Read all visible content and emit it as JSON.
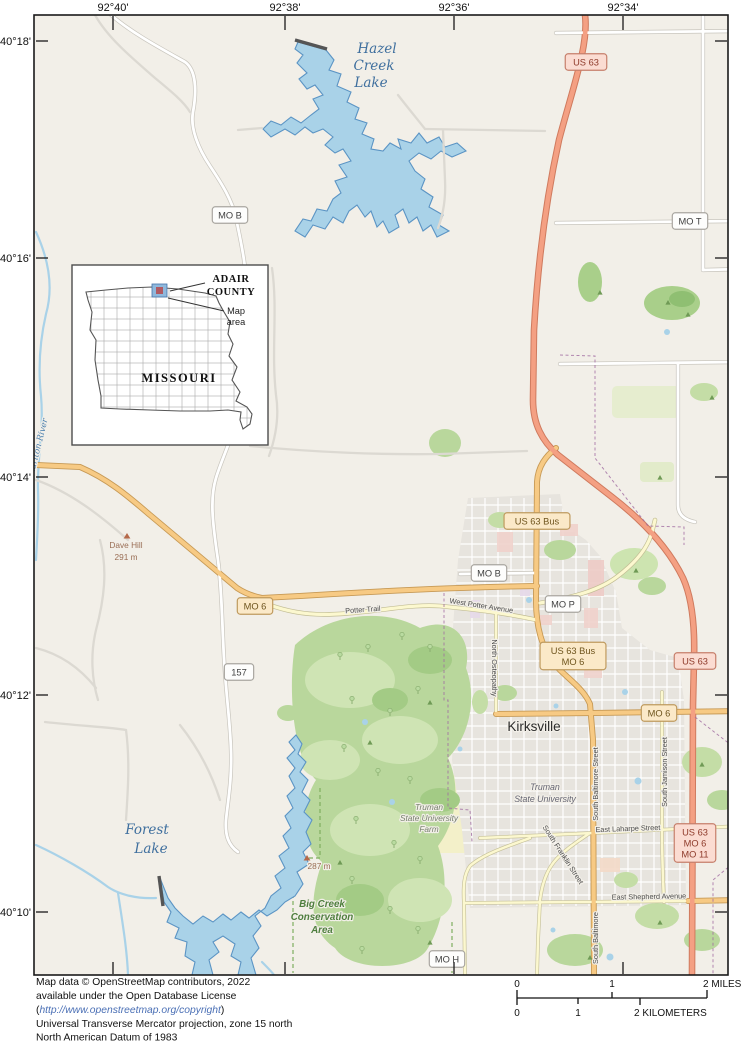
{
  "map": {
    "coordinates": {
      "top": [
        "92°40'",
        "92°38'",
        "92°36'",
        "92°34'"
      ],
      "left": [
        "40°18'",
        "40°16'",
        "40°14'",
        "40°12'",
        "40°10'"
      ]
    },
    "inset": {
      "county_line1": "ADAIR",
      "county_line2": "COUNTY",
      "map_area_line1": "Map",
      "map_area_line2": "area",
      "state": "MISSOURI"
    },
    "shields": [
      {
        "name": "shield-us63-north",
        "type": "us",
        "lines": [
          "US 63"
        ],
        "x": 586,
        "y": 62
      },
      {
        "name": "shield-us63-east",
        "type": "us",
        "lines": [
          "US 63"
        ],
        "x": 695,
        "y": 661
      },
      {
        "name": "shield-us63-mo6-mo11",
        "type": "us",
        "lines": [
          "US 63",
          "MO 6",
          "MO 11"
        ],
        "x": 695,
        "y": 843
      },
      {
        "name": "shield-us63-bus",
        "type": "tan",
        "lines": [
          "US 63 Bus"
        ],
        "x": 537,
        "y": 521
      },
      {
        "name": "shield-us63-bus-mo6",
        "type": "tan",
        "lines": [
          "US 63 Bus",
          "MO 6"
        ],
        "x": 573,
        "y": 656
      },
      {
        "name": "shield-mo6-west",
        "type": "tan",
        "lines": [
          "MO 6"
        ],
        "x": 255,
        "y": 606
      },
      {
        "name": "shield-mo6-east",
        "type": "tan",
        "lines": [
          "MO 6"
        ],
        "x": 659,
        "y": 713
      },
      {
        "name": "shield-mo-b-north",
        "type": "white",
        "lines": [
          "MO B"
        ],
        "x": 230,
        "y": 215
      },
      {
        "name": "shield-mo-b-city",
        "type": "white",
        "lines": [
          "MO B"
        ],
        "x": 489,
        "y": 573
      },
      {
        "name": "shield-mo-p",
        "type": "white",
        "lines": [
          "MO P"
        ],
        "x": 563,
        "y": 604
      },
      {
        "name": "shield-mo-t",
        "type": "white",
        "lines": [
          "MO T"
        ],
        "x": 690,
        "y": 221
      },
      {
        "name": "shield-157",
        "type": "white",
        "lines": [
          "157"
        ],
        "x": 239,
        "y": 672
      },
      {
        "name": "shield-mo-h",
        "type": "white",
        "lines": [
          "MO H"
        ],
        "x": 447,
        "y": 959
      }
    ],
    "labels": [
      {
        "name": "hazel-creek-lake-label-1",
        "text": "Hazel",
        "x": 377,
        "y": 53,
        "cls": "lake"
      },
      {
        "name": "hazel-creek-lake-label-2",
        "text": "Creek",
        "x": 374,
        "y": 70,
        "cls": "lake"
      },
      {
        "name": "hazel-creek-lake-label-3",
        "text": "Lake",
        "x": 371,
        "y": 87,
        "cls": "lake"
      },
      {
        "name": "forest-lake-label-1",
        "text": "Forest",
        "x": 147,
        "y": 834,
        "cls": "lake"
      },
      {
        "name": "forest-lake-label-2",
        "text": "Lake",
        "x": 151,
        "y": 853,
        "cls": "lake"
      },
      {
        "name": "chariton-river-label",
        "text": "Chariton River",
        "x": 40,
        "y": 450,
        "cls": "river",
        "rot": -76
      },
      {
        "name": "kirksville-label",
        "text": "Kirksville",
        "x": 534,
        "y": 731,
        "cls": "city"
      },
      {
        "name": "truman-university-label-1",
        "text": "Truman",
        "x": 545,
        "y": 790,
        "cls": "uni"
      },
      {
        "name": "truman-university-label-2",
        "text": "State University",
        "x": 545,
        "y": 802,
        "cls": "uni"
      },
      {
        "name": "truman-farm-label-1",
        "text": "Truman",
        "x": 429,
        "y": 810,
        "cls": "farm"
      },
      {
        "name": "truman-farm-label-2",
        "text": "State University",
        "x": 429,
        "y": 821,
        "cls": "farm"
      },
      {
        "name": "truman-farm-label-3",
        "text": "Farm",
        "x": 429,
        "y": 832,
        "cls": "farm"
      },
      {
        "name": "big-creek-label-1",
        "text": "Big Creek",
        "x": 322,
        "y": 907,
        "cls": "cons"
      },
      {
        "name": "big-creek-label-2",
        "text": "Conservation",
        "x": 322,
        "y": 920,
        "cls": "cons"
      },
      {
        "name": "big-creek-label-3",
        "text": "Area",
        "x": 322,
        "y": 933,
        "cls": "cons"
      },
      {
        "name": "dave-hill-label",
        "text": "Dave Hill",
        "x": 126,
        "y": 548,
        "cls": "peak"
      },
      {
        "name": "dave-hill-elevation-label",
        "text": "291 m",
        "x": 126,
        "y": 560,
        "cls": "peak"
      },
      {
        "name": "elevation-287-label",
        "text": "287 m",
        "x": 319,
        "y": 869,
        "cls": "peak"
      },
      {
        "name": "potter-trail-label",
        "text": "Potter Trail",
        "x": 363,
        "y": 612,
        "cls": "street",
        "rot": -4
      },
      {
        "name": "west-potter-avenue-label",
        "text": "West Potter Avenue",
        "x": 481,
        "y": 608,
        "cls": "street",
        "rot": 9
      },
      {
        "name": "north-osteopathy-label",
        "text": "North Osteopathy",
        "x": 492,
        "y": 668,
        "cls": "street",
        "rot": 90
      },
      {
        "name": "south-baltimore-street-label",
        "text": "South Baltimore Street",
        "x": 598,
        "y": 784,
        "cls": "street",
        "rot": -90
      },
      {
        "name": "south-baltimore-street-label-2",
        "text": "South Baltimore",
        "x": 598,
        "y": 938,
        "cls": "street",
        "rot": -90
      },
      {
        "name": "south-jamison-street-label",
        "text": "South Jamison Street",
        "x": 667,
        "y": 772,
        "cls": "street",
        "rot": -90
      },
      {
        "name": "south-franklin-street-label",
        "text": "South Franklin Street",
        "x": 561,
        "y": 856,
        "cls": "street",
        "rot": 57
      },
      {
        "name": "east-laharpe-street-label",
        "text": "East Laharpe Street",
        "x": 628,
        "y": 831,
        "cls": "street",
        "rot": -2
      },
      {
        "name": "east-shepherd-avenue-label",
        "text": "East Shepherd Avenue",
        "x": 649,
        "y": 899,
        "cls": "street",
        "rot": -1
      }
    ],
    "peak_icons": [
      {
        "name": "dave-hill-peak-icon",
        "x": 127,
        "y": 538
      },
      {
        "name": "elevation-287-peak-icon",
        "x": 307,
        "y": 860
      }
    ],
    "scale": {
      "miles_0": "0",
      "miles_1": "1",
      "miles_2": "2 MILES",
      "km_0": "0",
      "km_1": "1",
      "km_2": "2 KILOMETERS"
    },
    "attribution": {
      "line1": "Map data © OpenStreetMap contributors, 2022",
      "line2": "available under the Open Database License",
      "line3_prefix": "(",
      "line3_url": "http://www.openstreetmap.org/copyright",
      "line3_suffix": ")",
      "line4": "Universal Transverse Mercator projection, zone 15 north",
      "line5": "North American Datum of 1983"
    },
    "colors": {
      "background": "#f2efe8",
      "water": "#a9d2e8",
      "water_outline": "#5b94c4",
      "forest": "#b9d79c",
      "urban": "#e7e4de",
      "us_route": "#f4a083",
      "state_route": "#f7ca84",
      "minor_route": "#fcf8cf",
      "adair_highlight": "#8fb8dc",
      "adair_center": "#b05a63"
    }
  }
}
